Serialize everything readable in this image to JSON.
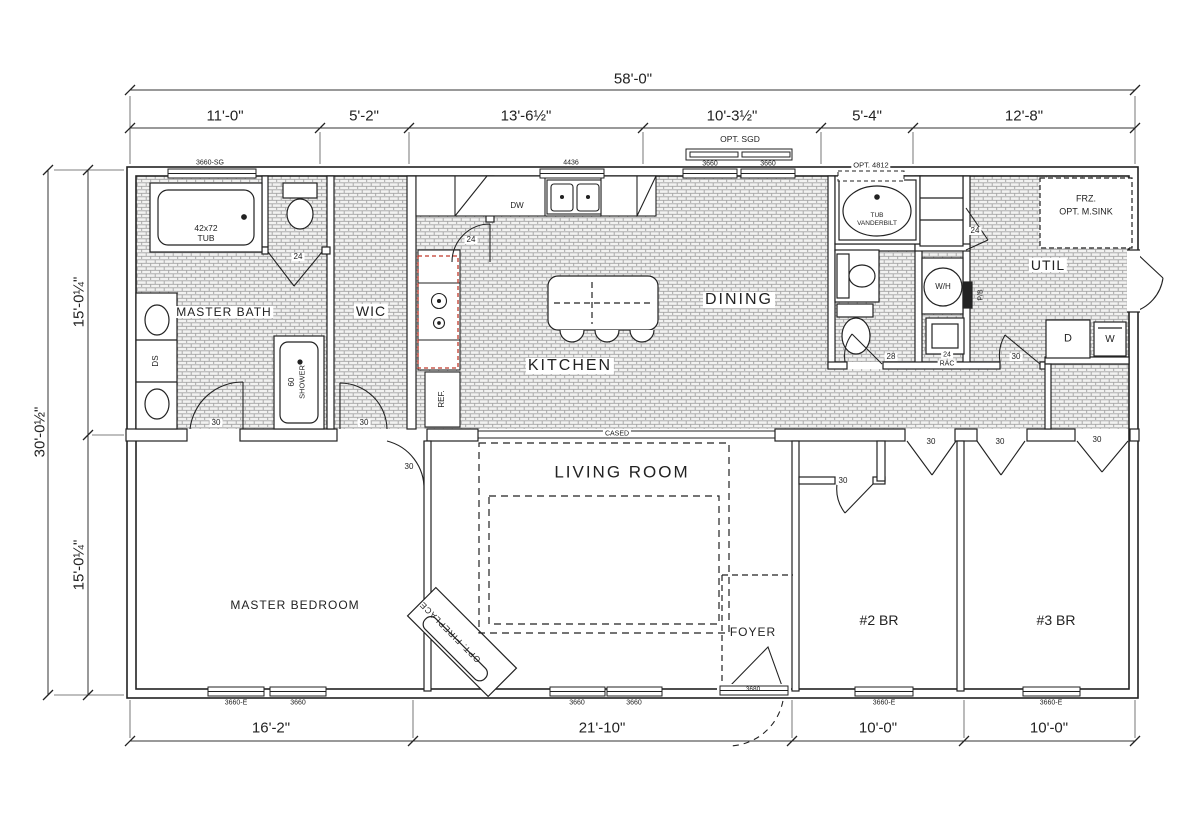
{
  "colors": {
    "ink": "#222222",
    "tile_line": "#a3a3a3",
    "accent_red": "#c0392b"
  },
  "dims": {
    "top_total": "58'-0\"",
    "top_segments": [
      "11'-0\"",
      "5'-2\"",
      "13'-6½\"",
      "10'-3½\"",
      "5'-4\"",
      "12'-8\""
    ],
    "left_total": "30'-0½\"",
    "left_segments": [
      "15'-0¼\"",
      "15'-0¼\""
    ],
    "bottom_segments": [
      "16'-2\"",
      "21'-10\"",
      "10'-0\"",
      "10'-0\""
    ]
  },
  "rooms": {
    "master_bath": "MASTER BATH",
    "wic": "WIC",
    "kitchen": "KITCHEN",
    "dining": "DINING",
    "util": "UTIL",
    "living_room": "LIVING ROOM",
    "master_bedroom": "MASTER BEDROOM",
    "foyer": "FOYER",
    "bedroom2": "#2 BR",
    "bedroom3": "#3 BR"
  },
  "openings": {
    "w3660": "3660",
    "w3660e": "3660-E",
    "w3660sg": "3660-SG",
    "w4436": "4436",
    "w3680": "3680",
    "opt_sgd": "OPT. SGD",
    "opt_4812": "OPT. 4812",
    "cased": "CASED",
    "d24": "24",
    "d28": "28",
    "d30": "30",
    "rac": "RAC"
  },
  "fixtures": {
    "tub_size": "42x72",
    "tub": "TUB",
    "dual_sinks": "DS",
    "shower_size": "60",
    "shower": "SHOWER",
    "dishwasher": "DW",
    "fridge": "REF.",
    "tub2_brand": "VANDERBILT",
    "water_heater": "W/H",
    "pb": "P/B",
    "freezer": "FRZ.",
    "opt_msink": "OPT. M.SINK",
    "dryer": "D",
    "washer": "W",
    "fireplace": "OPT. FIREPLACE"
  }
}
